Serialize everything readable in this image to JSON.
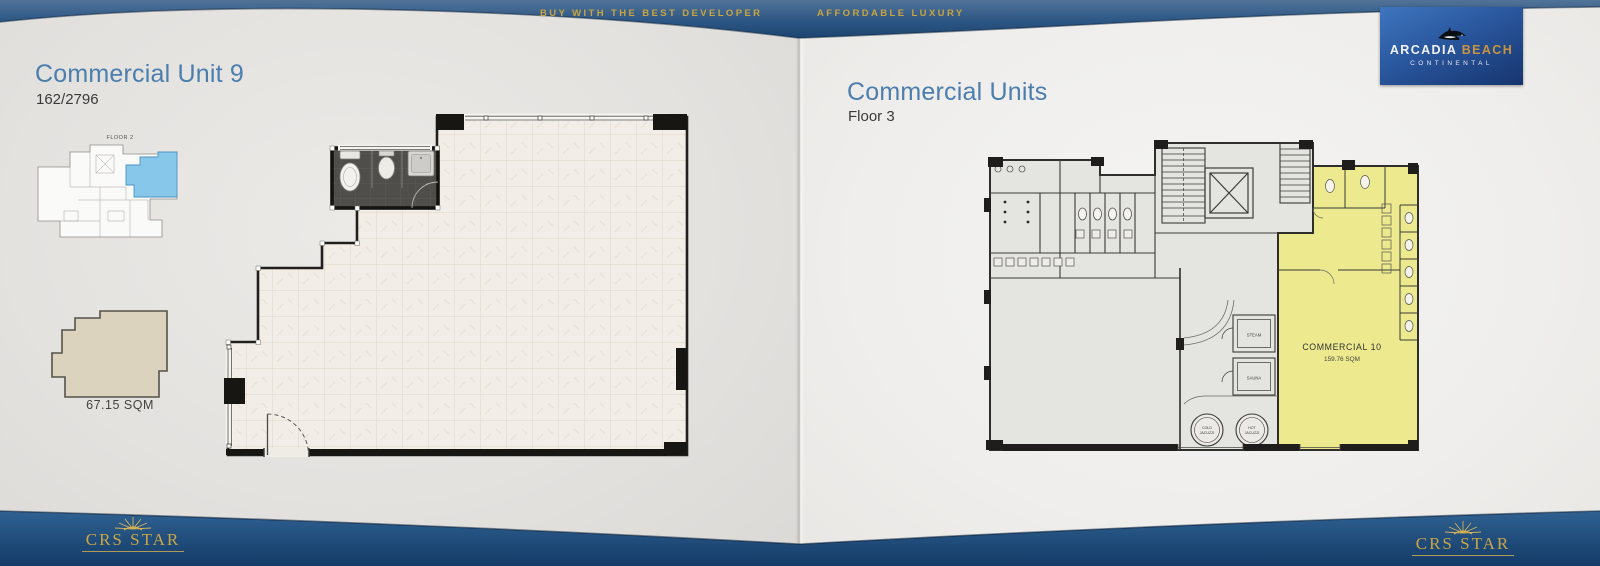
{
  "header": {
    "slogan_left": "BUY WITH THE BEST DEVELOPER",
    "slogan_right": "AFFORDABLE LUXURY",
    "logo": {
      "icon": "orca-icon",
      "name_primary": "ARCADIA",
      "name_secondary": "BEACH",
      "subtitle": "CONTINENTAL"
    },
    "band_color": "#1d4571",
    "gold_color": "#c9a53f"
  },
  "left_page": {
    "title": "Commercial Unit 9",
    "subtitle": "162/2796",
    "thumbnail_label": "FLOOR 2",
    "thumbnail_highlight_color": "#87c7ea",
    "unit_shape_color": "#dbd3be",
    "area_label": "67.15 SQM"
  },
  "right_page": {
    "title": "Commercial Units",
    "subtitle": "Floor 3",
    "plan": {
      "highlight_color": "#ece98f",
      "commercial_name": "COMMERCIAL 10",
      "commercial_area": "159.76 SQM",
      "steam": "STEAM",
      "sauna": "SAUNA",
      "cold_jacuzzi_line1": "COLD",
      "cold_jacuzzi_line2": "JACUZZI",
      "hot_jacuzzi_line1": "HOT",
      "hot_jacuzzi_line2": "JACUZZI"
    }
  },
  "footer": {
    "icon": "sun-rays-icon",
    "brand_left": "CRS STAR",
    "brand_right": "CRS STAR"
  }
}
